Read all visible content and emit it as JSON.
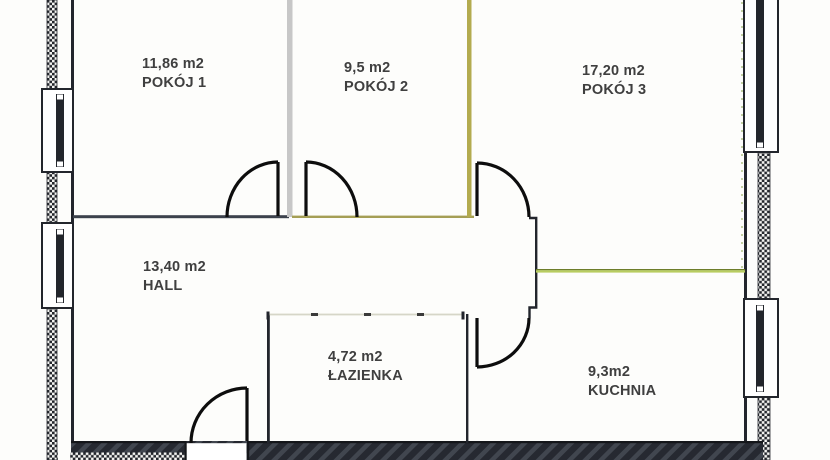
{
  "plan": {
    "title": "apartment-floor-plan",
    "rooms": [
      {
        "area": "11,86 m2",
        "name": "POKÓJ 1"
      },
      {
        "area": "9,5 m2",
        "name": "POKÓJ 2"
      },
      {
        "area": "17,20 m2",
        "name": "POKÓJ 3"
      },
      {
        "area": "13,40 m2",
        "name": "HALL"
      },
      {
        "area": "4,72 m2",
        "name": "ŁAZIENKA"
      },
      {
        "area": "9,3m2",
        "name": "KUCHNIA"
      }
    ],
    "colors": {
      "background": "#fdfdfb",
      "wall_dark": "#22252c",
      "wall_slate": "#3c424c",
      "divider_gray": "#c7c7c7",
      "divider_olive": "#b3ab4f",
      "wall_khaki": "#a59f55",
      "green_line": "#b8cd60",
      "green_line_edge": "#6d7d2a",
      "faint_partition": "#d6d6c8",
      "door": "#0d0d0d",
      "text": "#3f3f3f"
    }
  }
}
